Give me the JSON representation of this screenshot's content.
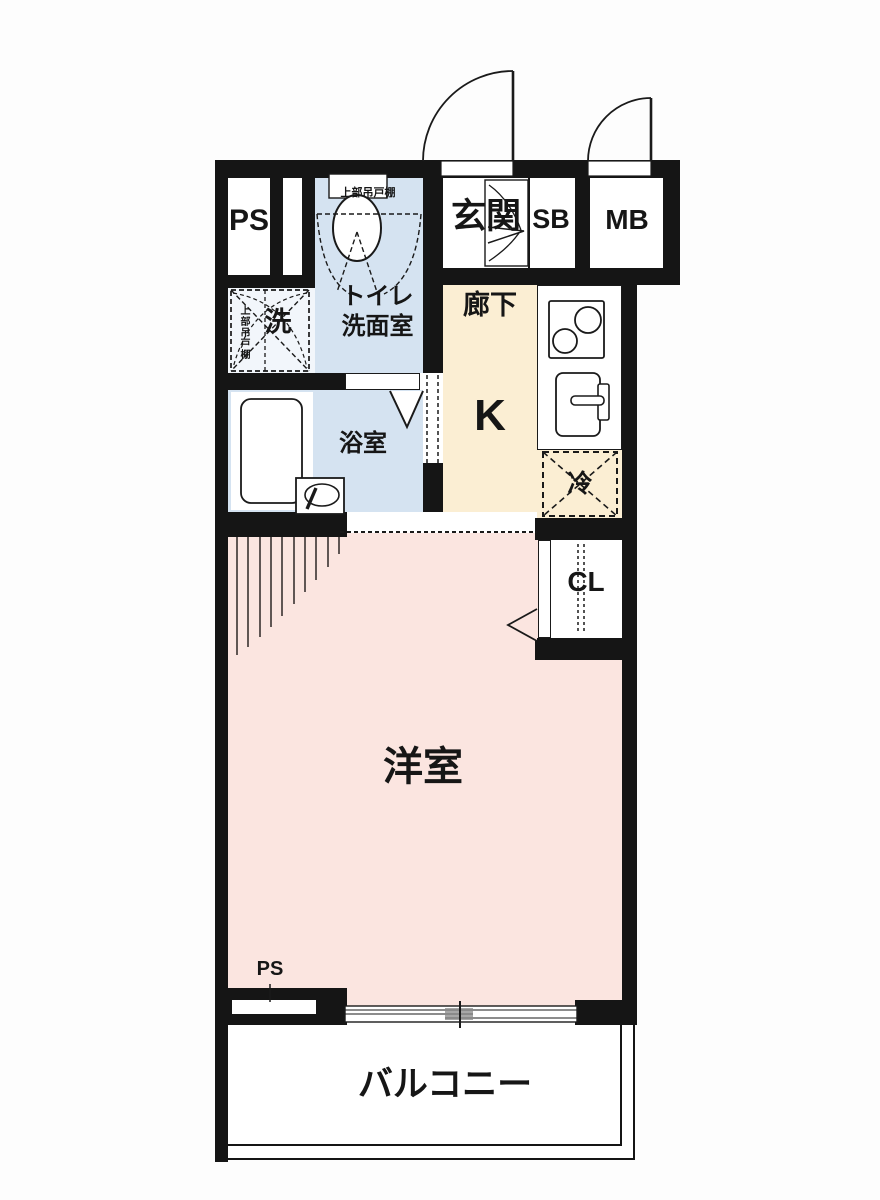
{
  "plan": {
    "rooms": {
      "ps_top": "PS",
      "washroom_shelf_note": "上部吊戸棚",
      "toilet_washroom_line1": "トイレ",
      "toilet_washroom_line2": "洗面室",
      "entrance": "玄関",
      "shoe_box": "SB",
      "meter_box": "MB",
      "corridor": "廊下",
      "kitchen": "K",
      "laundry": "洗",
      "laundry_shelf_note": "上部吊戸棚",
      "bathroom": "浴室",
      "refrigerator": "冷",
      "closet": "CL",
      "western_room": "洋室",
      "ps_bottom": "PS",
      "balcony": "バルコニー"
    },
    "colors": {
      "wall": "#151515",
      "wet_area": "#d5e3f1",
      "laundry_area": "#f2f6fb",
      "corridor_kitchen": "#fbeed3",
      "living": "#fbe5e0",
      "room_white": "#ffffff"
    }
  }
}
